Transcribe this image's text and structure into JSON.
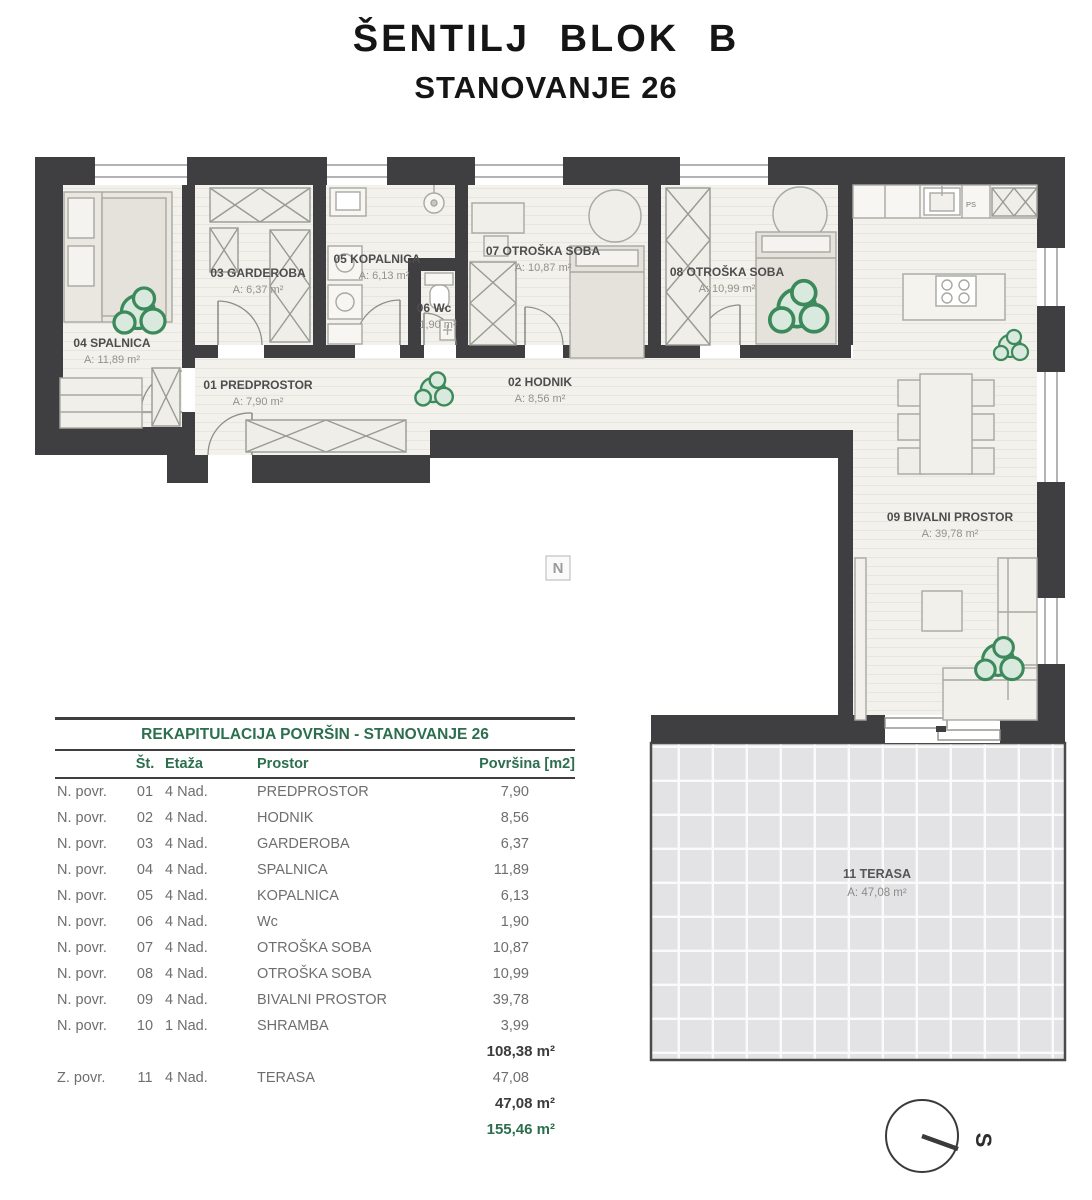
{
  "title": {
    "line1": "ŠENTILJ BLOK B",
    "line2": "STANOVANJE 26"
  },
  "watermark": "N",
  "compass": {
    "label": "S"
  },
  "plan": {
    "ps_label": "PS",
    "rooms": [
      {
        "id": "01",
        "name": "01 PREDPROSTOR",
        "area": "A: 7,90 m²"
      },
      {
        "id": "02",
        "name": "02 HODNIK",
        "area": "A: 8,56 m²"
      },
      {
        "id": "03",
        "name": "03 GARDEROBA",
        "area": "A: 6,37 m²"
      },
      {
        "id": "04",
        "name": "04 SPALNICA",
        "area": "A: 11,89 m²"
      },
      {
        "id": "05",
        "name": "05 KOPALNICA",
        "area": "A: 6,13 m²"
      },
      {
        "id": "06",
        "name": "06 Wc",
        "area": "1,90 m²"
      },
      {
        "id": "07",
        "name": "07 OTROŠKA SOBA",
        "area": "A: 10,87 m²"
      },
      {
        "id": "08",
        "name": "08 OTROŠKA SOBA",
        "area": "A: 10,99 m²"
      },
      {
        "id": "09",
        "name": "09 BIVALNI PROSTOR",
        "area": "A: 39,78 m²"
      },
      {
        "id": "11",
        "name": "11 TERASA",
        "area": "A: 47,08 m²"
      }
    ]
  },
  "table": {
    "title": "REKAPITULACIJA POVRŠIN - STANOVANJE 26",
    "columns": {
      "st": "Št.",
      "etaza": "Etaža",
      "prostor": "Prostor",
      "povrsina": "Površina [m2]"
    },
    "rows": [
      {
        "type": "N. povr.",
        "num": "01",
        "etaza": "4 Nad.",
        "prostor": "PREDPROSTOR",
        "value": "7,90"
      },
      {
        "type": "N. povr.",
        "num": "02",
        "etaza": "4 Nad.",
        "prostor": "HODNIK",
        "value": "8,56"
      },
      {
        "type": "N. povr.",
        "num": "03",
        "etaza": "4 Nad.",
        "prostor": "GARDEROBA",
        "value": "6,37"
      },
      {
        "type": "N. povr.",
        "num": "04",
        "etaza": "4 Nad.",
        "prostor": "SPALNICA",
        "value": "11,89"
      },
      {
        "type": "N. povr.",
        "num": "05",
        "etaza": "4 Nad.",
        "prostor": "KOPALNICA",
        "value": "6,13"
      },
      {
        "type": "N. povr.",
        "num": "06",
        "etaza": "4 Nad.",
        "prostor": "Wc",
        "value": "1,90"
      },
      {
        "type": "N. povr.",
        "num": "07",
        "etaza": "4 Nad.",
        "prostor": "OTROŠKA SOBA",
        "value": "10,87"
      },
      {
        "type": "N. povr.",
        "num": "08",
        "etaza": "4 Nad.",
        "prostor": "OTROŠKA SOBA",
        "value": "10,99"
      },
      {
        "type": "N. povr.",
        "num": "09",
        "etaza": "4 Nad.",
        "prostor": "BIVALNI PROSTOR",
        "value": "39,78"
      },
      {
        "type": "N. povr.",
        "num": "10",
        "etaza": "1 Nad.",
        "prostor": "SHRAMBA",
        "value": "3,99"
      },
      {
        "type": "Z. povr.",
        "num": "11",
        "etaza": "4 Nad.",
        "prostor": "TERASA",
        "value": "47,08"
      }
    ],
    "subtotal_n": "108,38 m²",
    "subtotal_z": "47,08 m²",
    "total": "155,46 m²"
  },
  "colors": {
    "wall": "#3f3f41",
    "floor": "#f2f1ec",
    "terrace": "#e3e3e5",
    "accent_green": "#2c6e4e",
    "plant_green": "#3c8a5c"
  }
}
